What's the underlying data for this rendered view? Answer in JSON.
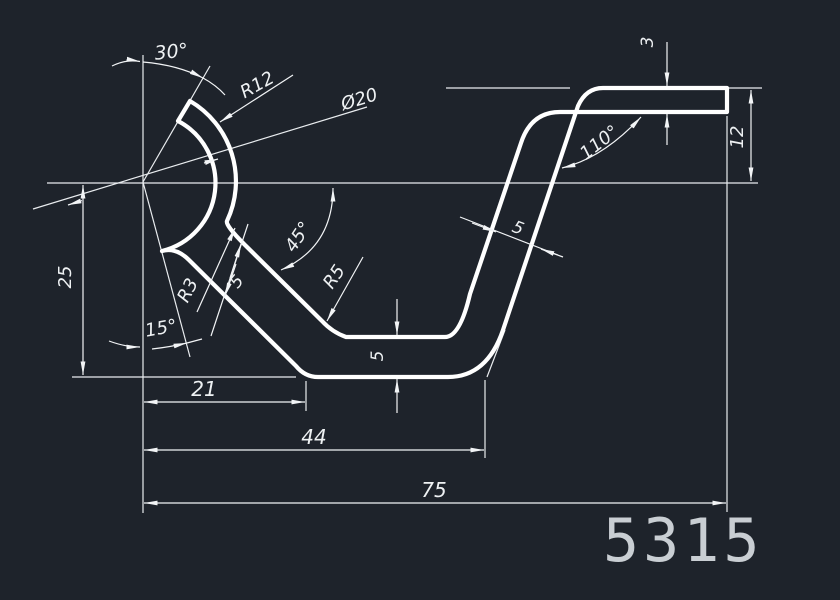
{
  "drawing": {
    "part_number": "5315",
    "background_color": "#1e232b",
    "line_color": "#f2f4f6",
    "part_number_color": "#c9ced3",
    "dimensions": {
      "angle_top": "30°",
      "radius_large": "R12",
      "diameter": "Ø20",
      "angle_right": "110°",
      "thickness_top": "3",
      "height_right": "12",
      "height_left": "25",
      "angle_mid": "45°",
      "radius_mid": "R5",
      "radius_small": "R3",
      "thickness_left": "5",
      "thickness_right": "5",
      "thickness_bottom": "5",
      "angle_bottom": "15°",
      "width_small": "21",
      "width_mid": "44",
      "width_large": "75"
    }
  }
}
